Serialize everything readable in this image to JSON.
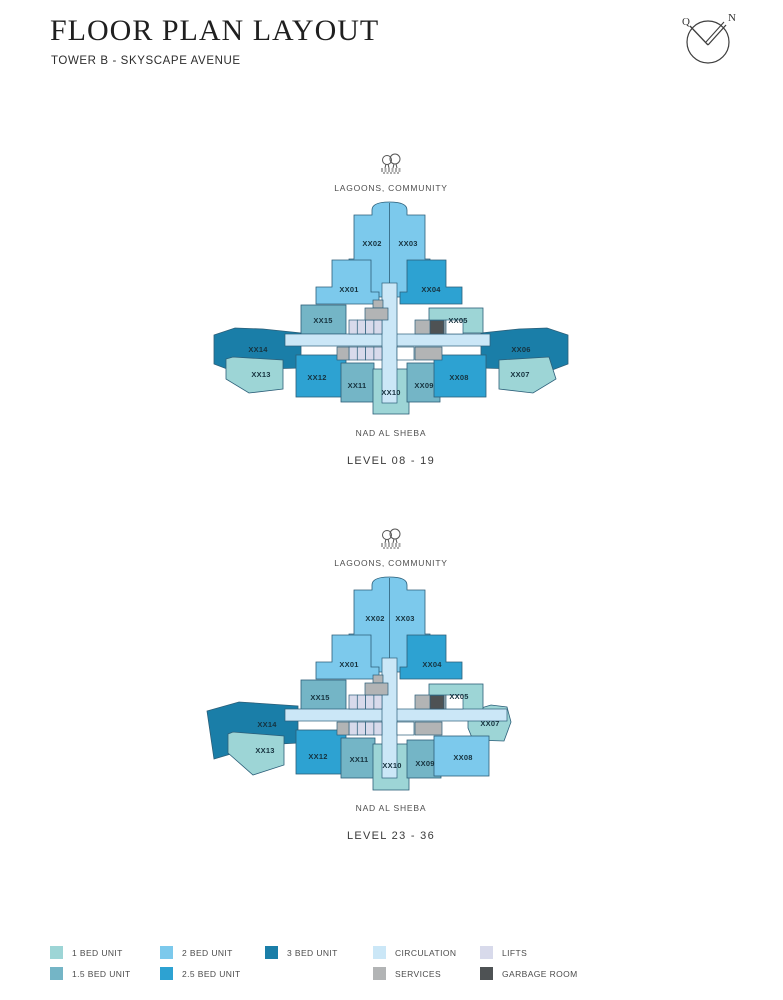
{
  "header": {
    "title": "FLOOR PLAN LAYOUT",
    "subtitle": "TOWER B - SKYSCAPE AVENUE",
    "compass_left": "Q",
    "compass_right": "N"
  },
  "colors": {
    "one_bed": "#9dd5d6",
    "one_half_bed": "#74b5c6",
    "two_bed": "#7cc9ec",
    "two_half_bed": "#2da2d2",
    "three_bed": "#1a7ea8",
    "circulation": "#cbe7f7",
    "lifts": "#d8daeb",
    "services": "#b2b4b5",
    "garbage": "#4e5254",
    "white": "#ffffff",
    "outline": "#2c5f79"
  },
  "plans": [
    {
      "id": "plan1",
      "top_label": "LAGOONS, COMMUNITY",
      "bottom_label": "NAD AL SHEBA",
      "level_label": "LEVEL 08 - 19",
      "units": [
        {
          "id": "XX01",
          "label": "XX01",
          "type": "two_bed"
        },
        {
          "id": "XX02",
          "label": "XX02",
          "type": "two_bed"
        },
        {
          "id": "XX03",
          "label": "XX03",
          "type": "two_bed"
        },
        {
          "id": "XX04",
          "label": "XX04",
          "type": "two_half_bed"
        },
        {
          "id": "XX05",
          "label": "XX05",
          "type": "one_bed"
        },
        {
          "id": "XX06",
          "label": "XX06",
          "type": "three_bed"
        },
        {
          "id": "XX07",
          "label": "XX07",
          "type": "one_bed"
        },
        {
          "id": "XX08",
          "label": "XX08",
          "type": "two_half_bed"
        },
        {
          "id": "XX09",
          "label": "XX09",
          "type": "one_half_bed"
        },
        {
          "id": "XX10",
          "label": "XX10",
          "type": "one_bed"
        },
        {
          "id": "XX11",
          "label": "XX11",
          "type": "one_half_bed"
        },
        {
          "id": "XX12",
          "label": "XX12",
          "type": "two_half_bed"
        },
        {
          "id": "XX13",
          "label": "XX13",
          "type": "one_bed"
        },
        {
          "id": "XX14",
          "label": "XX14",
          "type": "three_bed"
        },
        {
          "id": "XX15",
          "label": "XX15",
          "type": "one_half_bed"
        }
      ]
    },
    {
      "id": "plan2",
      "top_label": "LAGOONS, COMMUNITY",
      "bottom_label": "NAD AL SHEBA",
      "level_label": "LEVEL 23 - 36",
      "units": [
        {
          "id": "XX01",
          "label": "XX01",
          "type": "two_bed"
        },
        {
          "id": "XX02",
          "label": "XX02",
          "type": "two_bed"
        },
        {
          "id": "XX03",
          "label": "XX03",
          "type": "two_bed"
        },
        {
          "id": "XX04",
          "label": "XX04",
          "type": "two_half_bed"
        },
        {
          "id": "XX05",
          "label": "XX05",
          "type": "one_bed"
        },
        {
          "id": "XX07",
          "label": "XX07",
          "type": "one_bed"
        },
        {
          "id": "XX08",
          "label": "XX08",
          "type": "two_bed"
        },
        {
          "id": "XX09",
          "label": "XX09",
          "type": "one_half_bed"
        },
        {
          "id": "XX10",
          "label": "XX10",
          "type": "one_bed"
        },
        {
          "id": "XX11",
          "label": "XX11",
          "type": "one_half_bed"
        },
        {
          "id": "XX12",
          "label": "XX12",
          "type": "two_half_bed"
        },
        {
          "id": "XX13",
          "label": "XX13",
          "type": "one_bed"
        },
        {
          "id": "XX14",
          "label": "XX14",
          "type": "three_bed"
        },
        {
          "id": "XX15",
          "label": "XX15",
          "type": "one_half_bed"
        }
      ]
    }
  ],
  "legend": {
    "rows": [
      [
        {
          "label": "1 BED UNIT",
          "type": "one_bed"
        },
        {
          "label": "2 BED UNIT",
          "type": "two_bed"
        },
        {
          "label": "3 BED UNIT",
          "type": "three_bed"
        },
        {
          "label": "CIRCULATION",
          "type": "circulation"
        },
        {
          "label": "LIFTS",
          "type": "lifts"
        }
      ],
      [
        {
          "label": "1.5 BED UNIT",
          "type": "one_half_bed"
        },
        {
          "label": "2.5 BED UNIT",
          "type": "two_half_bed"
        },
        {
          "label": "SERVICES",
          "type": "services"
        },
        {
          "label": "GARBAGE ROOM",
          "type": "garbage"
        }
      ]
    ]
  }
}
